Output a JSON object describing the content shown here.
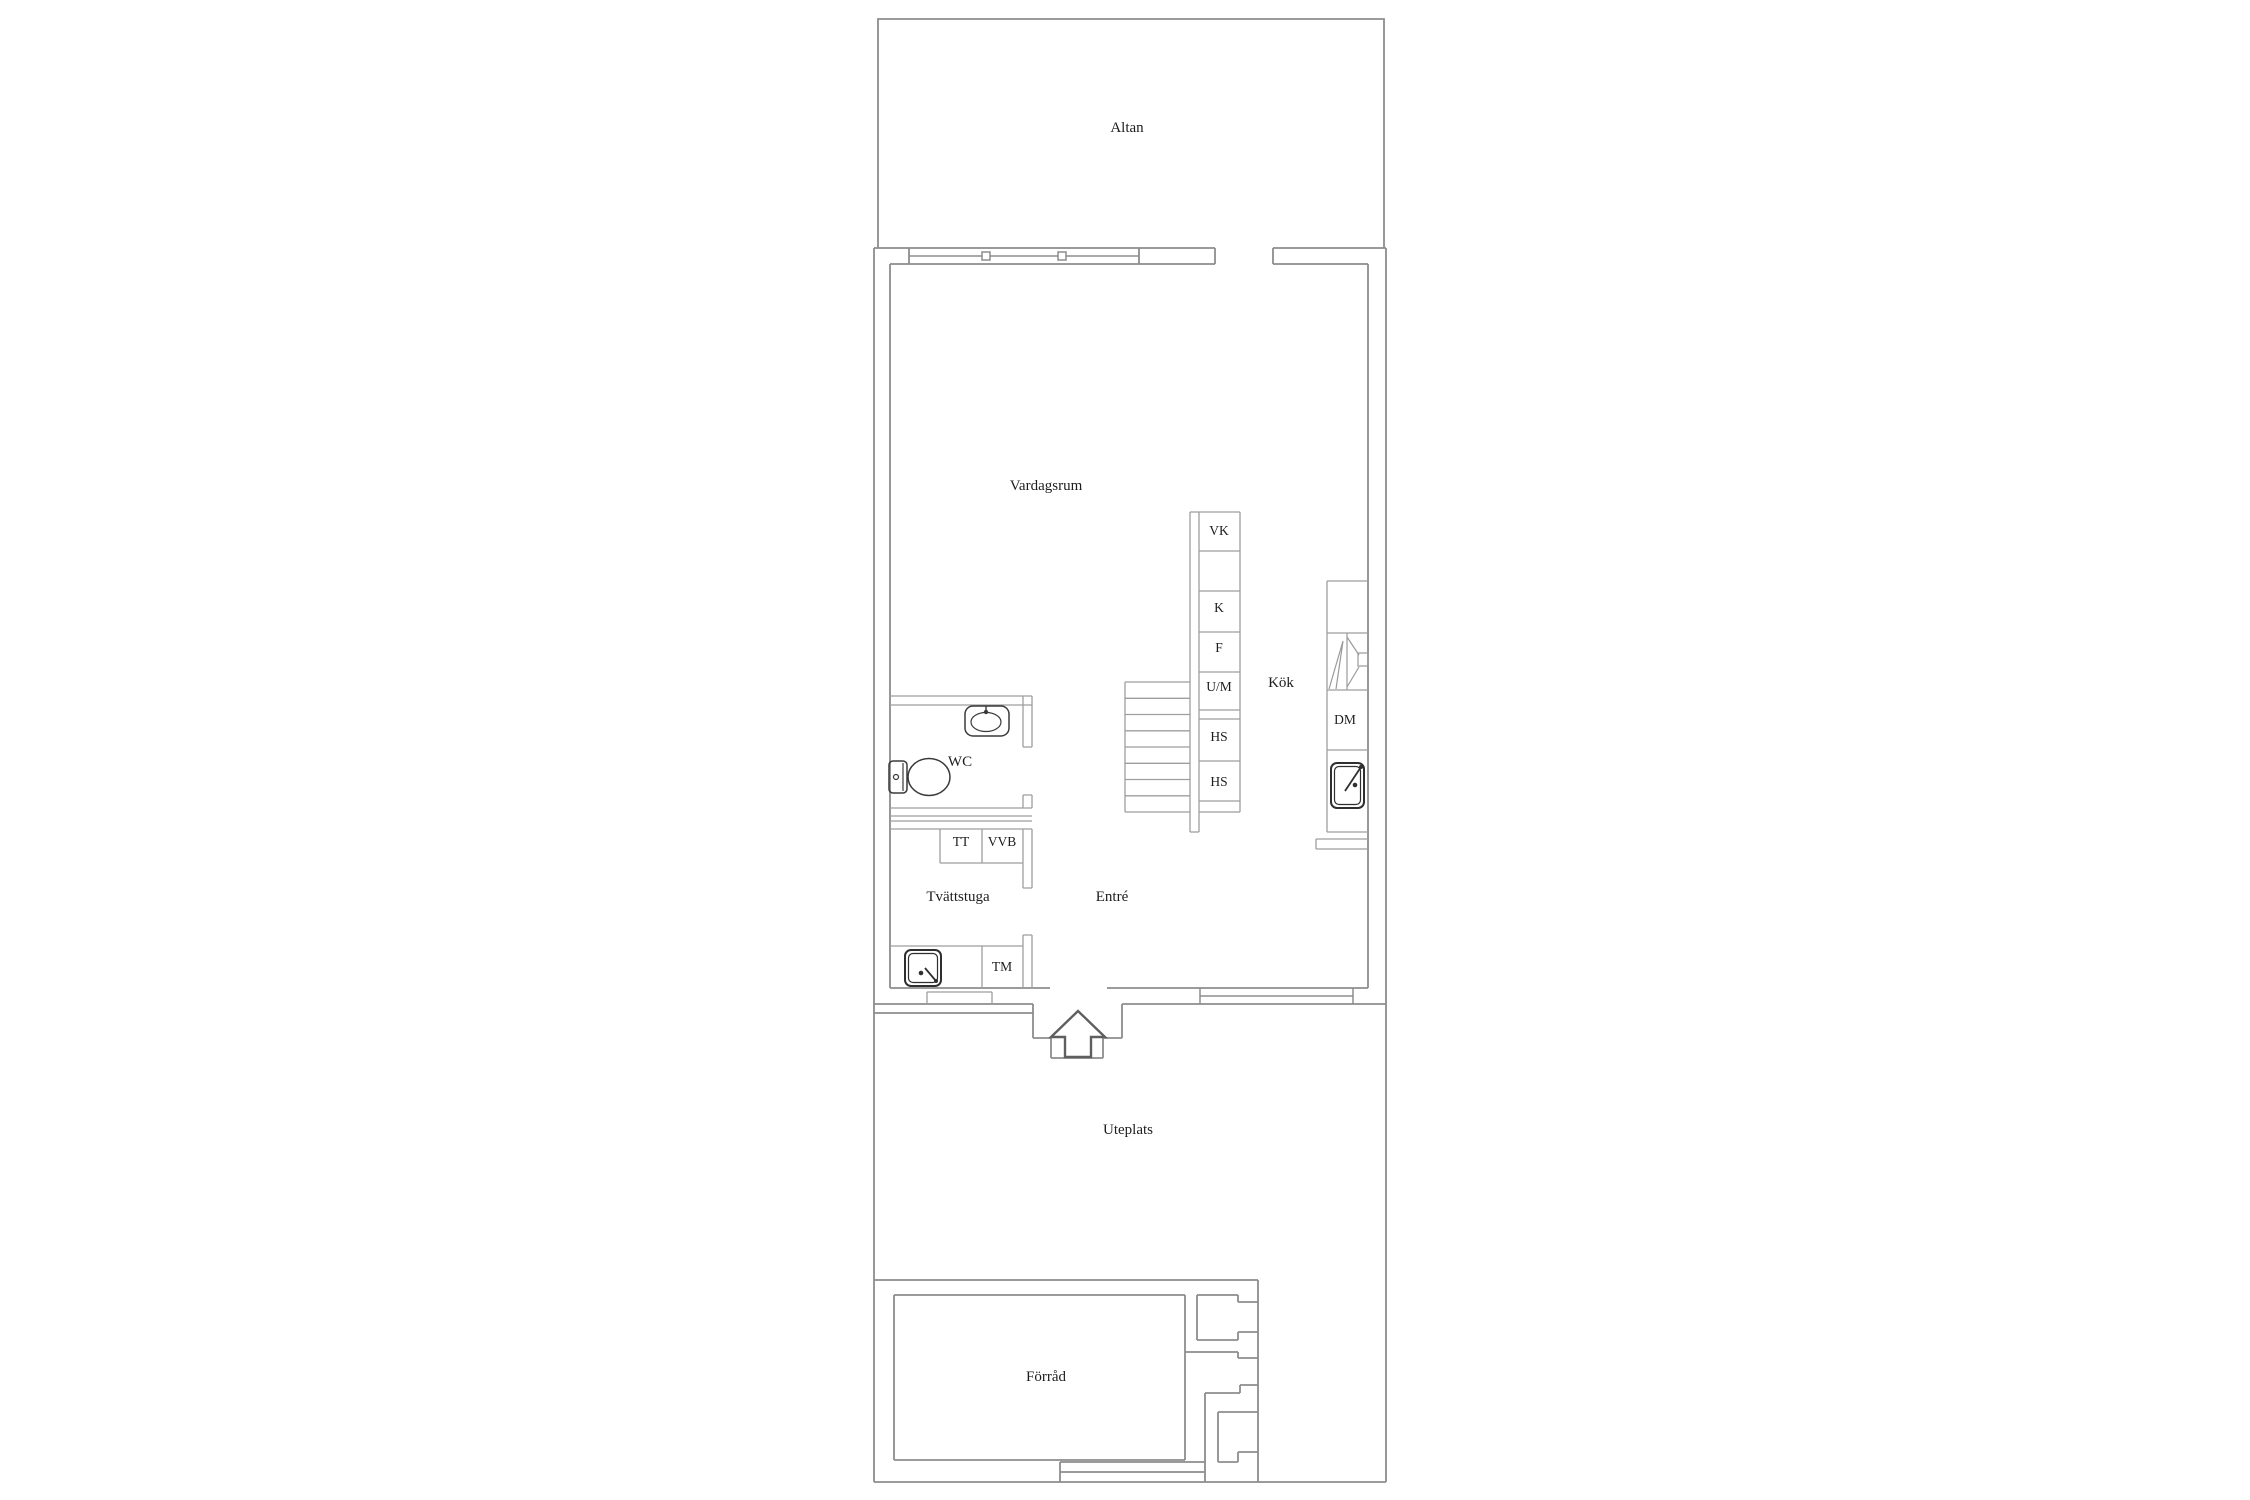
{
  "floorplan": {
    "rooms": [
      {
        "id": "altan",
        "label": "Altan"
      },
      {
        "id": "vardagsrum",
        "label": "Vardagsrum"
      },
      {
        "id": "kok",
        "label": "Kök"
      },
      {
        "id": "wc",
        "label": "WC"
      },
      {
        "id": "tvattstuga",
        "label": "Tvättstuga"
      },
      {
        "id": "entre",
        "label": "Entré"
      },
      {
        "id": "uteplats",
        "label": "Uteplats"
      },
      {
        "id": "forrad",
        "label": "Förråd"
      }
    ],
    "fixtures": [
      {
        "id": "vk",
        "label": "VK"
      },
      {
        "id": "k",
        "label": "K"
      },
      {
        "id": "f",
        "label": "F"
      },
      {
        "id": "um",
        "label": "U/M"
      },
      {
        "id": "hs-upper",
        "label": "HS"
      },
      {
        "id": "hs-lower",
        "label": "HS"
      },
      {
        "id": "dm",
        "label": "DM"
      },
      {
        "id": "tt",
        "label": "TT"
      },
      {
        "id": "vvb",
        "label": "VVB"
      },
      {
        "id": "tm",
        "label": "TM"
      }
    ],
    "icons": [
      "toilet-icon",
      "washbasin-icon",
      "kitchen-sink-icon",
      "laundry-sink-icon",
      "stove-icon",
      "window-icon",
      "entrance-arrow-icon",
      "stairs-icon"
    ],
    "colors": {
      "background": "#ffffff",
      "exterior-wall-line": "#8d8d8d",
      "interior-wall-line": "#9e9e9e",
      "icon-line": "#3a3a3a",
      "label-text": "#1d1d1d"
    }
  }
}
